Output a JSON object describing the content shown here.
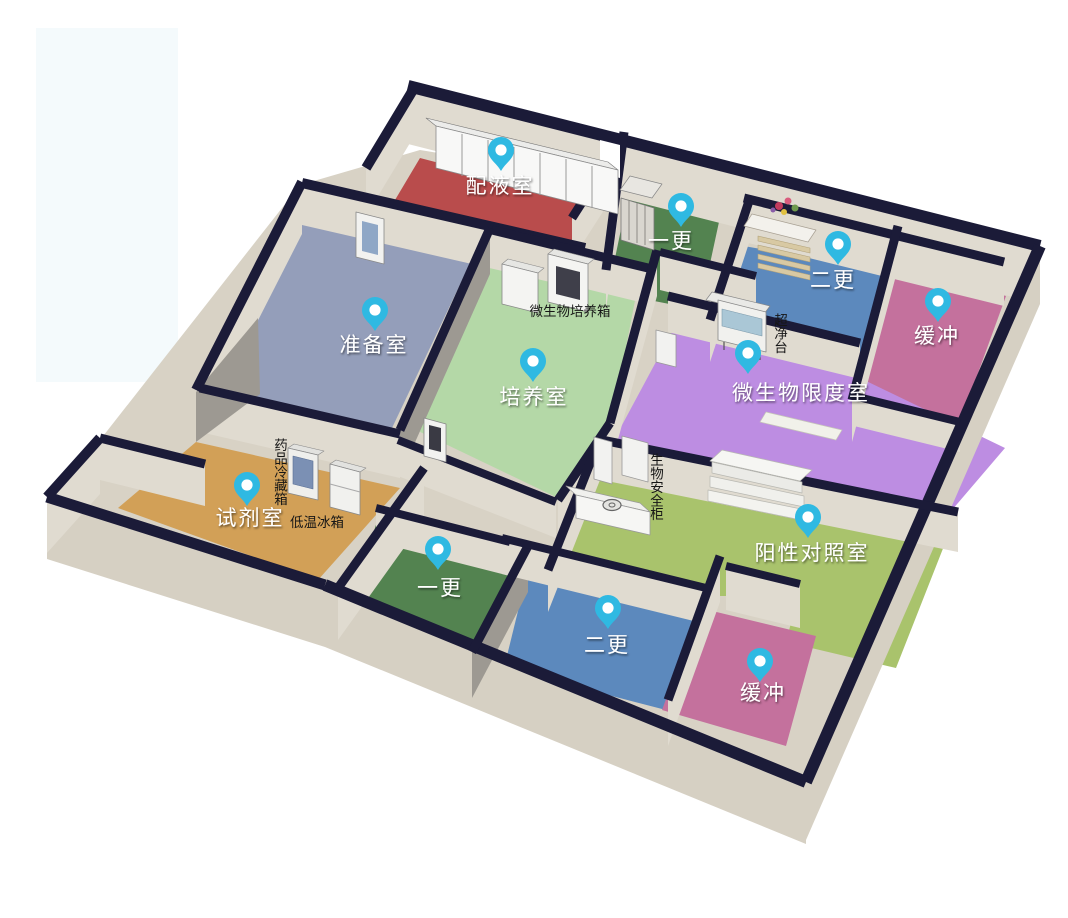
{
  "diagram_title": "洁净实验室三维布局图",
  "rooms": [
    {
      "id": "peiyeshi",
      "label": "配液室",
      "floor_color": "#b94c4c"
    },
    {
      "id": "zhunbeishi",
      "label": "准备室",
      "floor_color": "#949eba"
    },
    {
      "id": "peiyangshi",
      "label": "培养室",
      "floor_color": "#b4d8a7"
    },
    {
      "id": "yigeng-top",
      "label": "一更",
      "floor_color": "#538350"
    },
    {
      "id": "ergeng-top",
      "label": "二更",
      "floor_color": "#5c89bd"
    },
    {
      "id": "huanchong-top",
      "label": "缓冲",
      "floor_color": "#c4719d"
    },
    {
      "id": "weishengwu-xiandushi",
      "label": "微生物限度室",
      "floor_color": "#bd8de2"
    },
    {
      "id": "yangxing-duizhaoshi",
      "label": "阳性对照室",
      "floor_color": "#a9c36c"
    },
    {
      "id": "shijishi",
      "label": "试剂室",
      "floor_color": "#d2a057"
    },
    {
      "id": "yigeng-bottom",
      "label": "一更",
      "floor_color": "#538350"
    },
    {
      "id": "ergeng-bottom",
      "label": "二更",
      "floor_color": "#5c89bd"
    },
    {
      "id": "huanchong-bottom",
      "label": "缓冲",
      "floor_color": "#c4719d"
    }
  ],
  "equipment_labels": [
    {
      "id": "weishengwu-peiyangxiang",
      "text": "微生物培养箱"
    },
    {
      "id": "chaojingtai",
      "text": "超净台"
    },
    {
      "id": "yaopin-lengcangxiang",
      "text": "药品冷藏箱"
    },
    {
      "id": "diwen-bingxiang",
      "text": "低温冰箱"
    },
    {
      "id": "shengwu-anquangui",
      "text": "生物安全柜"
    }
  ],
  "palette": {
    "background": "#ffffff",
    "watermark_patch": "#f4fafc",
    "wall_top": "#1b1b38",
    "wall_face": "#e0dbd0",
    "wall_face_dark": "#d6d0c3",
    "wall_gray": "#9d9992",
    "corridor_floor": "#d8d2c5",
    "pin_color": "#2fb9e2",
    "pin_hole": "#ffffff"
  }
}
